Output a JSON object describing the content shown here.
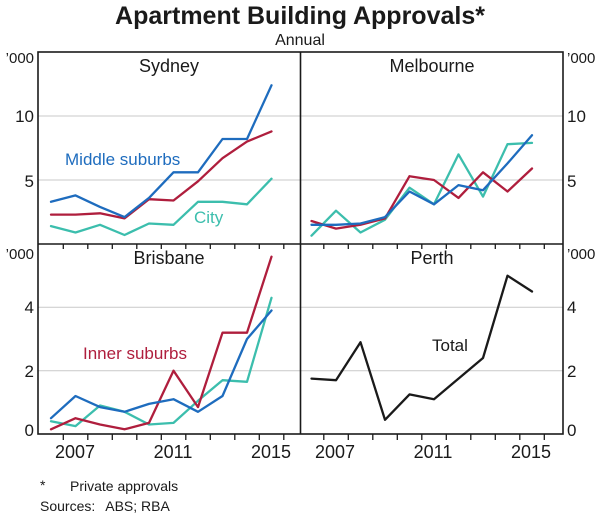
{
  "header": {
    "title": "Apartment Building Approvals*",
    "subtitle": "Annual"
  },
  "y_axis": {
    "unit": "’000",
    "top_row_ticks": [
      "10",
      "5"
    ],
    "bottom_row_ticks": [
      "4",
      "2",
      "0"
    ]
  },
  "x_axis": {
    "labels": [
      "2007",
      "2011",
      "2015"
    ]
  },
  "footer": {
    "marker": "*",
    "note": "Private approvals",
    "sources_label": "Sources:",
    "sources": "ABS; RBA"
  },
  "colors": {
    "middle_suburbs": "#1E6CBE",
    "inner_suburbs": "#AF1E3D",
    "city": "#3CBEAD",
    "total": "#1A1A1A",
    "grid": "#C9C9C9",
    "axis": "#1A1A1A"
  },
  "chart_data": [
    {
      "type": "line",
      "title": "Sydney",
      "unit": "’000",
      "x": [
        2006,
        2007,
        2008,
        2009,
        2010,
        2011,
        2012,
        2013,
        2014,
        2015
      ],
      "x_tick_labels": [
        "2007",
        "2011",
        "2015"
      ],
      "ylim": [
        0,
        15
      ],
      "ygrid": [
        5,
        10
      ],
      "series": [
        {
          "name": "City",
          "color": "#3CBEAD",
          "values": [
            1.4,
            0.9,
            1.5,
            0.7,
            1.6,
            1.5,
            3.3,
            3.3,
            3.1,
            5.1
          ]
        },
        {
          "name": "Inner suburbs",
          "color": "#AF1E3D",
          "values": [
            2.3,
            2.3,
            2.4,
            2.0,
            3.5,
            3.4,
            4.9,
            6.7,
            8.0,
            8.8
          ]
        },
        {
          "name": "Middle suburbs",
          "color": "#1E6CBE",
          "values": [
            3.3,
            3.8,
            2.9,
            2.1,
            3.6,
            5.6,
            5.6,
            8.2,
            8.2,
            12.4
          ]
        }
      ]
    },
    {
      "type": "line",
      "title": "Melbourne",
      "unit": "’000",
      "x": [
        2006,
        2007,
        2008,
        2009,
        2010,
        2011,
        2012,
        2013,
        2014,
        2015
      ],
      "x_tick_labels": [
        "2007",
        "2011",
        "2015"
      ],
      "ylim": [
        0,
        15
      ],
      "ygrid": [
        5,
        10
      ],
      "series": [
        {
          "name": "City",
          "color": "#3CBEAD",
          "values": [
            0.65,
            2.6,
            0.9,
            1.9,
            4.4,
            3.1,
            7.0,
            3.7,
            7.8,
            7.9
          ]
        },
        {
          "name": "Inner suburbs",
          "color": "#AF1E3D",
          "values": [
            1.8,
            1.2,
            1.5,
            2.0,
            5.3,
            5.0,
            3.6,
            5.6,
            4.1,
            5.9
          ]
        },
        {
          "name": "Middle suburbs",
          "color": "#1E6CBE",
          "values": [
            1.5,
            1.5,
            1.6,
            2.1,
            4.1,
            3.1,
            4.6,
            4.2,
            6.3,
            8.5
          ]
        }
      ]
    },
    {
      "type": "line",
      "title": "Brisbane",
      "unit": "’000",
      "x": [
        2006,
        2007,
        2008,
        2009,
        2010,
        2011,
        2012,
        2013,
        2014,
        2015
      ],
      "x_tick_labels": [
        "2007",
        "2011",
        "2015"
      ],
      "ylim": [
        0,
        6
      ],
      "ygrid": [
        2,
        4
      ],
      "series": [
        {
          "name": "City",
          "color": "#3CBEAD",
          "values": [
            0.4,
            0.25,
            0.9,
            0.7,
            0.3,
            0.35,
            1.05,
            1.7,
            1.65,
            4.3
          ]
        },
        {
          "name": "Inner suburbs",
          "color": "#AF1E3D",
          "values": [
            0.15,
            0.5,
            0.3,
            0.15,
            0.35,
            2.0,
            0.85,
            3.2,
            3.2,
            5.6
          ]
        },
        {
          "name": "Middle suburbs",
          "color": "#1E6CBE",
          "values": [
            0.5,
            1.2,
            0.85,
            0.7,
            0.95,
            1.1,
            0.7,
            1.2,
            3.0,
            3.9
          ]
        }
      ]
    },
    {
      "type": "line",
      "title": "Perth",
      "unit": "’000",
      "x": [
        2006,
        2007,
        2008,
        2009,
        2010,
        2011,
        2012,
        2013,
        2014,
        2015
      ],
      "x_tick_labels": [
        "2007",
        "2011",
        "2015"
      ],
      "ylim": [
        0,
        6
      ],
      "ygrid": [
        2,
        4
      ],
      "series": [
        {
          "name": "Total",
          "color": "#1A1A1A",
          "values": [
            1.75,
            1.7,
            2.9,
            0.45,
            1.25,
            1.1,
            1.75,
            2.4,
            5.0,
            4.5
          ]
        }
      ]
    }
  ]
}
